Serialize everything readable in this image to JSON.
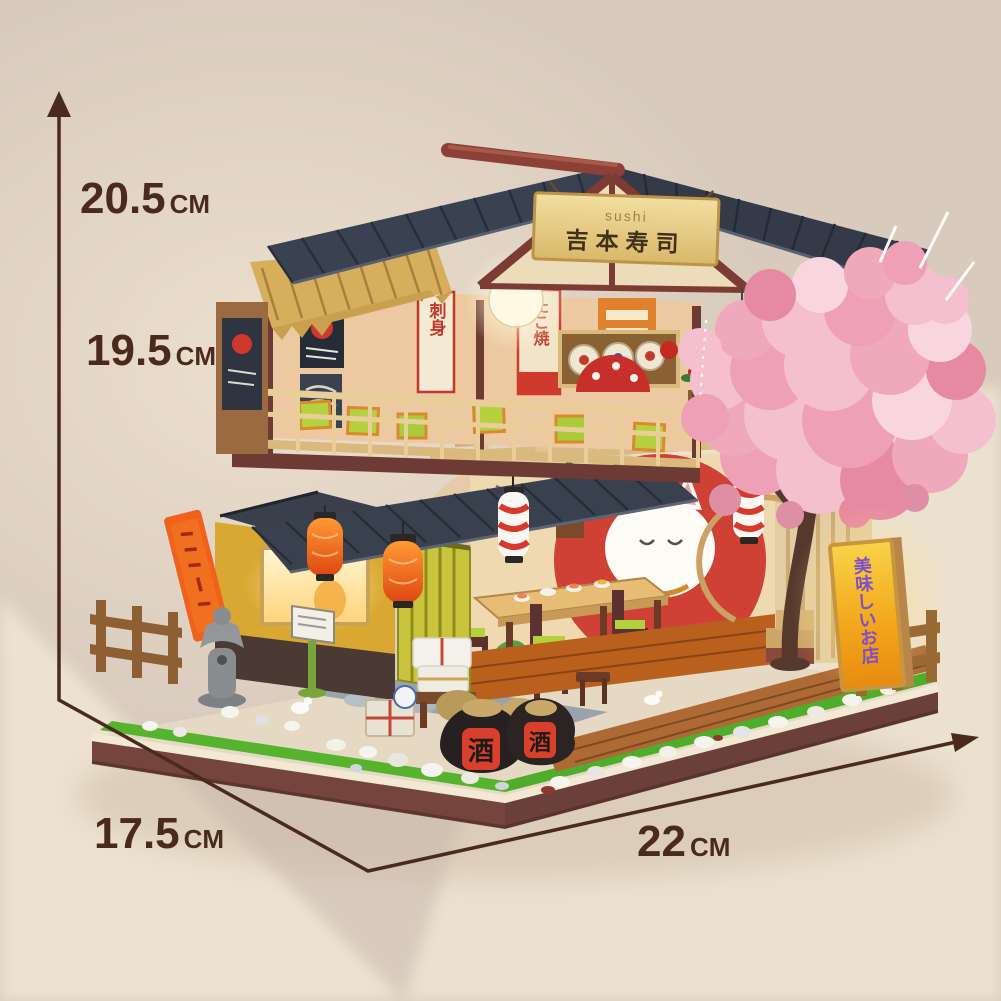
{
  "meta": {
    "type": "product-dimension-photo",
    "subject": "DIY miniature dollhouse kit - two-story Japanese sushi restaurant with cherry blossom tree and illuminated signs"
  },
  "dimensions": {
    "height_upper": {
      "value": "20.5",
      "unit": "CM"
    },
    "height_lower": {
      "value": "19.5",
      "unit": "CM"
    },
    "depth": {
      "value": "17.5",
      "unit": "CM"
    },
    "width": {
      "value": "22",
      "unit": "CM"
    }
  },
  "signs": {
    "roof_sign_subtitle": "sushi",
    "roof_sign_title": "吉本寿司",
    "banner_sashimi": "刺身",
    "banner_takoyaki": "たこ焼",
    "standing_sign": "美味しいお店",
    "sake_jar_label": "酒"
  },
  "palette": {
    "wall": "#d8cbbd",
    "floor": "#ede2d0",
    "dimension": "#4a2a1d",
    "roof_dark": "#3a4150",
    "roof_dark2": "#343a48",
    "beam_maroon": "#7c3c34",
    "base_maroon": "#74443d",
    "wood_light": "#d9ba83",
    "grass": "#55b32d",
    "lantern_orange": "#f07020",
    "blossom_pink": "#f0a8bb",
    "sign_glow": "#f6c235",
    "mural_red": "#ce4134"
  }
}
